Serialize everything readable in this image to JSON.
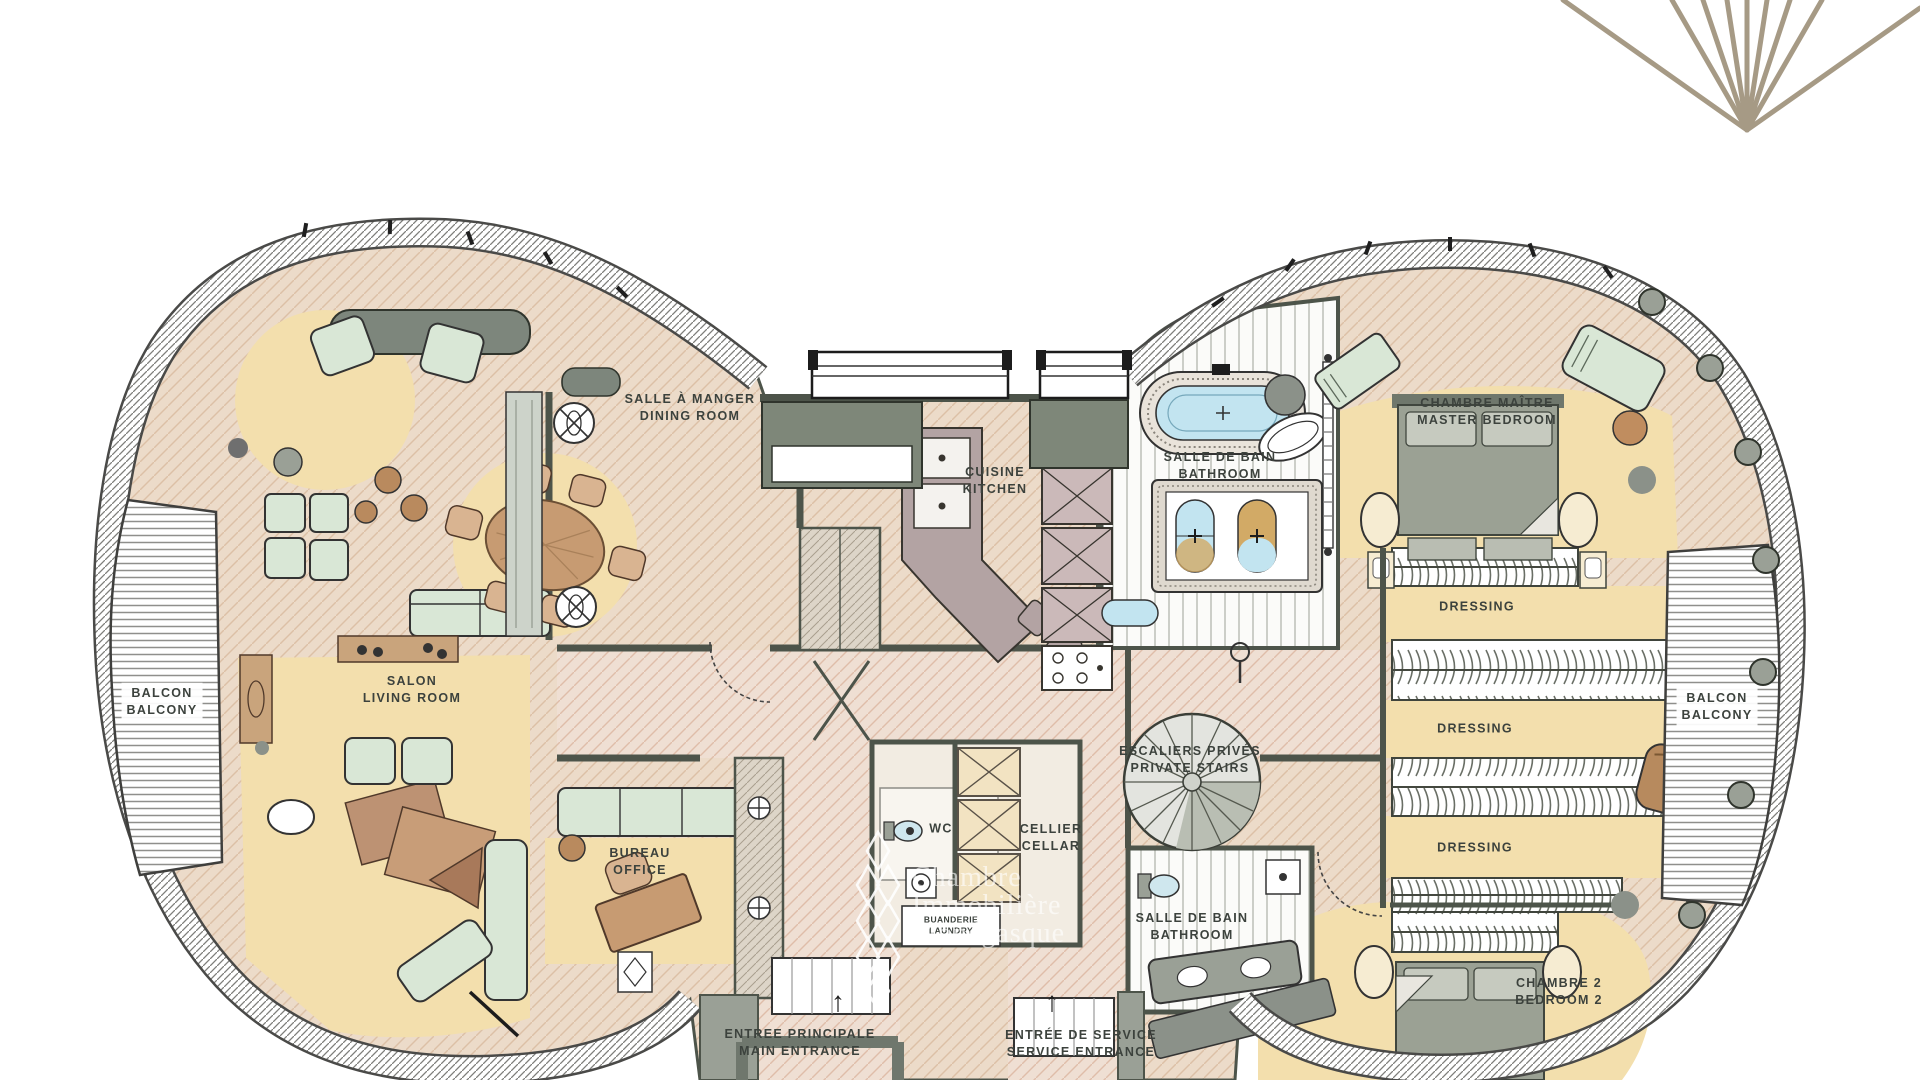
{
  "branding": {
    "watermark": {
      "line1": "Chambre",
      "line2": "Immobilière",
      "line3": "Monégasque"
    },
    "fan_logo_color": "#a69a85"
  },
  "rooms": {
    "dining": {
      "fr": "SALLE À MANGER",
      "en": "DINING ROOM"
    },
    "kitchen": {
      "fr": "CUISINE",
      "en": "KITCHEN"
    },
    "master_bathroom": {
      "fr": "SALLE DE BAIN",
      "en": "BATHROOM"
    },
    "master_bedroom": {
      "fr": "CHAMBRE MAÎTRE",
      "en": "MASTER BEDROOM"
    },
    "dressing_1": {
      "label": "DRESSING"
    },
    "dressing_2": {
      "label": "DRESSING"
    },
    "dressing_3": {
      "label": "DRESSING"
    },
    "balcony_left": {
      "fr": "BALCON",
      "en": "BALCONY"
    },
    "balcony_right": {
      "fr": "BALCON",
      "en": "BALCONY"
    },
    "living_room": {
      "fr": "SALON",
      "en": "LIVING ROOM"
    },
    "office": {
      "fr": "BUREAU",
      "en": "OFFICE"
    },
    "wc": {
      "label": "WC"
    },
    "cellar": {
      "fr": "CELLIER",
      "en": "CELLAR"
    },
    "private_stairs": {
      "fr": "ESCALIERS PRIVÉS",
      "en": "PRIVATE STAIRS"
    },
    "laundry": {
      "fr": "BUANDERIE",
      "en": "LAUNDRY"
    },
    "bathroom_2": {
      "fr": "SALLE DE BAIN",
      "en": "BATHROOM"
    },
    "bedroom_2": {
      "fr": "CHAMBRE 2",
      "en": "BEDROOM 2"
    },
    "main_entrance": {
      "fr": "ENTREE PRINCIPALE",
      "en": "MAIN ENTRANCE"
    },
    "service_entrance": {
      "fr": "ENTRÉE DE SERVICE",
      "en": "SERVICE ENTRANCE"
    }
  },
  "symbols": {
    "up_arrow": "↑"
  },
  "colors": {
    "wall": "#4d544a",
    "floor": "#ecdbc9",
    "corridor": "#efdfd4",
    "rug": "#f3dfad",
    "furniture_green": "#d9e7d6",
    "wood": "#c79b72",
    "tub_blue": "#c2e4f0",
    "gray": "#8b9189"
  }
}
